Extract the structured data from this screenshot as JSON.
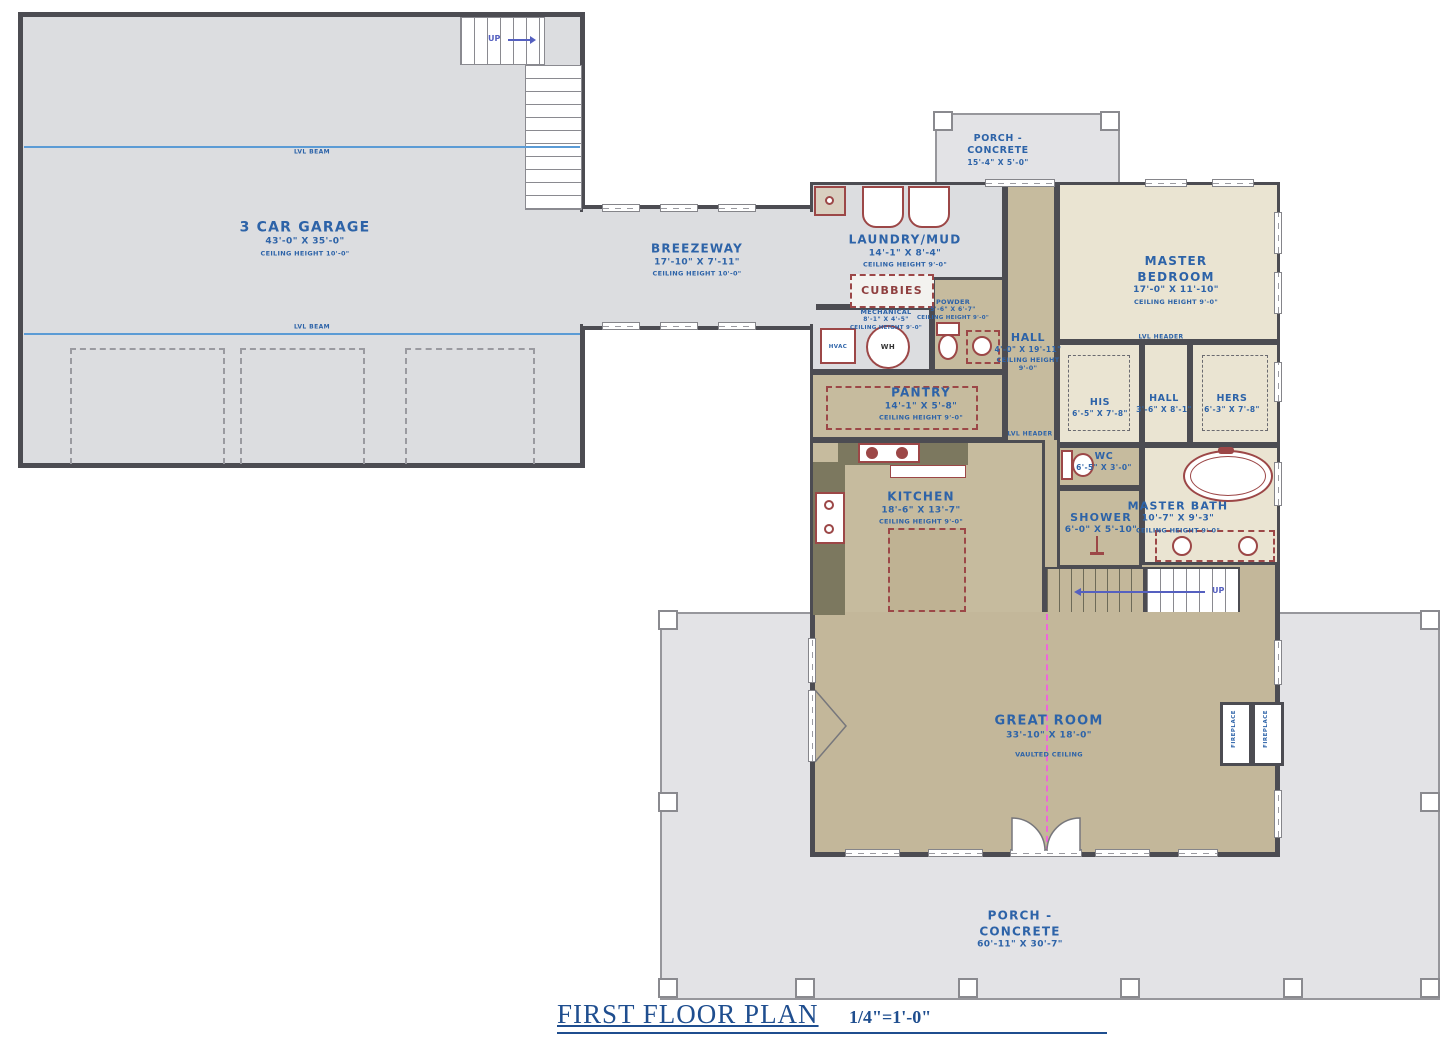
{
  "title": {
    "label": "FIRST FLOOR PLAN",
    "scale": "1/4\"=1'-0\""
  },
  "rooms": {
    "garage": {
      "name": "3 CAR GARAGE",
      "dims": "43'-0\" X 35'-0\"",
      "ceiling": "CEILING HEIGHT 10'-0\""
    },
    "breezeway": {
      "name": "BREEZEWAY",
      "dims": "17'-10\" X 7'-11\"",
      "ceiling": "CEILING HEIGHT 10'-0\""
    },
    "porch_top": {
      "name": "PORCH - CONCRETE",
      "dims": "15'-4\" X 5'-0\""
    },
    "laundry": {
      "name": "LAUNDRY/MUD",
      "dims": "14'-1\" X 8'-4\"",
      "ceiling": "CEILING HEIGHT 9'-0\""
    },
    "cubbies": {
      "name": "CUBBIES"
    },
    "powder": {
      "name": "POWDER",
      "dims": "5'-6\" X 6'-7\"",
      "ceiling": "CEILING HEIGHT 9'-0\""
    },
    "mechanical": {
      "name": "MECHANICAL",
      "dims": "8'-1\" X 4'-5\"",
      "ceiling": "CEILING HEIGHT 9'-0\""
    },
    "hall": {
      "name": "HALL",
      "dims": "4'-0\" X 19'-11\"",
      "ceiling": "CEILING HEIGHT 9'-0\""
    },
    "master_bedroom": {
      "name": "MASTER BEDROOM",
      "dims": "17'-0\" X 11'-10\"",
      "ceiling": "CEILING HEIGHT 9'-0\""
    },
    "his": {
      "name": "HIS",
      "dims": "6'-5\" X 7'-8\""
    },
    "closet_hall": {
      "name": "HALL",
      "dims": "3'-6\" X 8'-1\""
    },
    "hers": {
      "name": "HERS",
      "dims": "6'-3\" X 7'-8\""
    },
    "wc": {
      "name": "WC",
      "dims": "6'-5\" X 3'-0\""
    },
    "shower": {
      "name": "SHOWER",
      "dims": "6'-0\" X 5'-10\""
    },
    "master_bath": {
      "name": "MASTER BATH",
      "dims": "10'-7\" X 9'-3\"",
      "ceiling": "CEILING HEIGHT 9'-0\""
    },
    "pantry": {
      "name": "PANTRY",
      "dims": "14'-1\" X 5'-8\"",
      "ceiling": "CEILING HEIGHT 9'-0\""
    },
    "kitchen": {
      "name": "KITCHEN",
      "dims": "18'-6\" X 13'-7\"",
      "ceiling": "CEILING HEIGHT 9'-0\""
    },
    "great_room": {
      "name": "GREAT ROOM",
      "dims": "33'-10\" X 18'-0\"",
      "ceiling": "VAULTED CEILING"
    },
    "porch_bottom": {
      "name": "PORCH - CONCRETE",
      "dims": "60'-11\" X 30'-7\""
    }
  },
  "annotations": {
    "lvl_beam": "LVL BEAM",
    "lvl_header": "LVL HEADER",
    "up": "UP",
    "hvac": "HVAC",
    "wh": "WH",
    "fireplace": "FIREPLACE"
  },
  "colors": {
    "label_blue": "#2d63a8",
    "title_navy": "#1f4e8f",
    "fixture_red": "#9c4747",
    "floor_tan": "#c6bb9e",
    "floor_cream": "#eae4d2",
    "floor_gray": "#dcdde0",
    "porch_gray": "#e3e3e6",
    "beam_blue": "#5b9bd5",
    "ridge_magenta": "#ee66da"
  }
}
